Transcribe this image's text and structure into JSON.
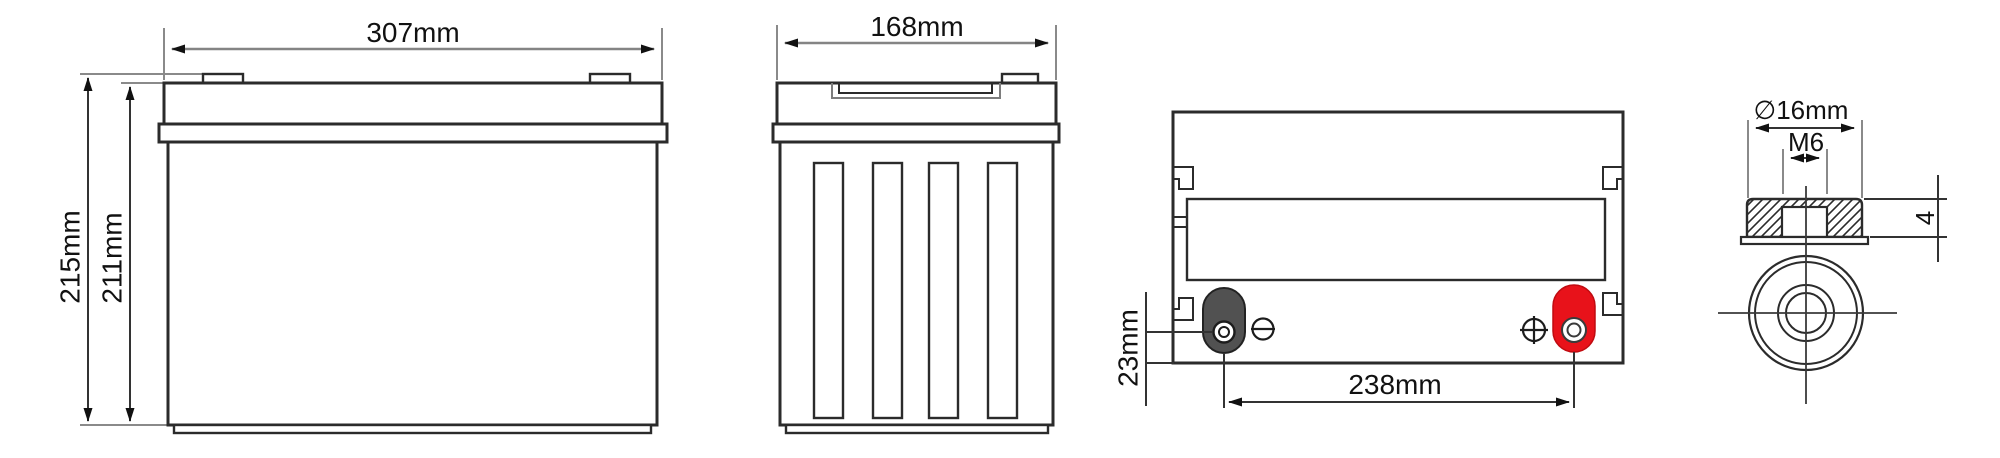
{
  "drawing": {
    "kind": "battery-dimension-drawing",
    "views": {
      "front": {
        "width_label": "307mm",
        "total_height_label": "215mm",
        "case_height_label": "211mm"
      },
      "side": {
        "depth_label": "168mm"
      },
      "top": {
        "terminal_offset_label": "23mm",
        "terminal_pitch_label": "238mm",
        "negative_terminal_icon": "circle-minus",
        "positive_terminal_icon": "circle-plus",
        "negative_terminal_color": "#515151",
        "positive_terminal_color": "#e8121a"
      },
      "terminal_detail": {
        "diameter_label": "∅16mm",
        "thread_label": "M6",
        "nut_height_label": "4"
      }
    }
  }
}
